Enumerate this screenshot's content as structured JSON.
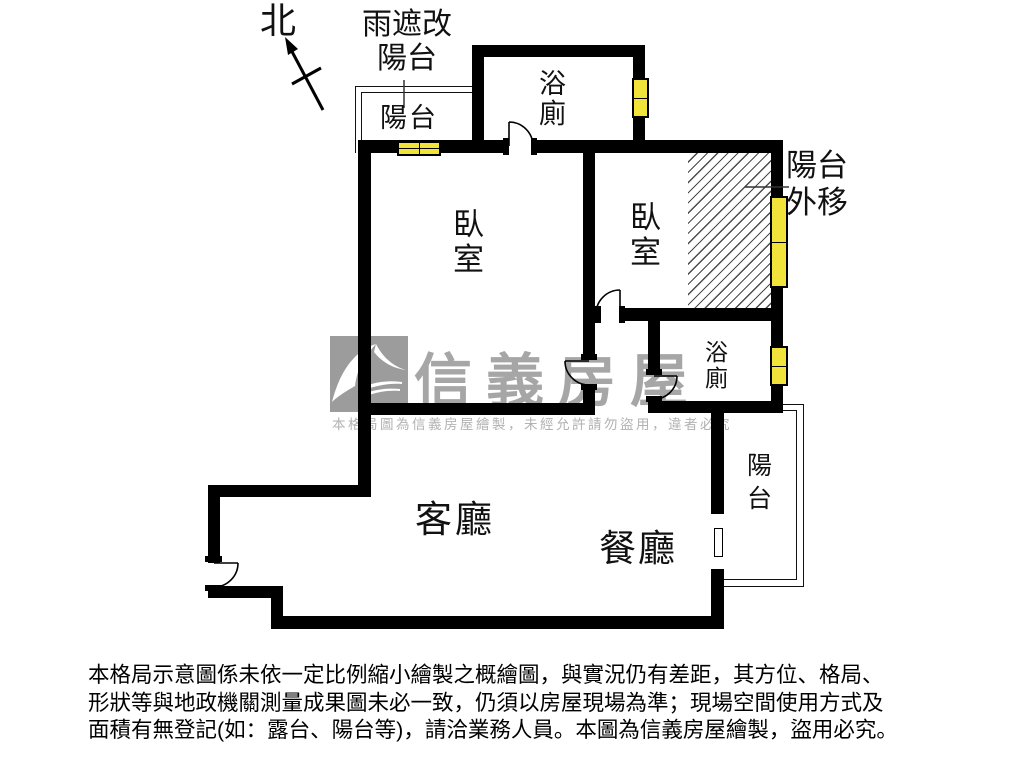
{
  "compass": {
    "north_label": "北"
  },
  "rooms": {
    "rain_cover_note": "雨遮改\n陽台",
    "balcony_top_left": "陽台",
    "bathroom_top": "浴\n廁",
    "bedroom_left": "臥\n室",
    "bedroom_right": "臥\n室",
    "balcony_moved_note": "陽台\n外移",
    "bathroom_mid": "浴\n廁",
    "living_room": "客廳",
    "dining_room": "餐廳",
    "balcony_right": "陽\n台"
  },
  "watermark": {
    "brand": "信義房屋",
    "notice": "本格局圖為信義房屋繪製，未經允許請勿盜用，違者必究"
  },
  "disclaimer": {
    "line1": "本格局示意圖係未依一定比例縮小繪製之概繪圖，與實況仍有差距，其方位、格局、",
    "line2": "形狀等與地政機關測量成果圖未必一致，仍須以房屋現場為準；現場空間使用方式及",
    "line3": "面積有無登記(如：露台、陽台等)，請洽業務人員。本圖為信義房屋繪製，盜用必究。"
  },
  "colors": {
    "wall": "#000000",
    "window_fill": "#f2e33b",
    "watermark_gray": "#a6a6a6",
    "hatch_line": "#4a4a4a"
  }
}
